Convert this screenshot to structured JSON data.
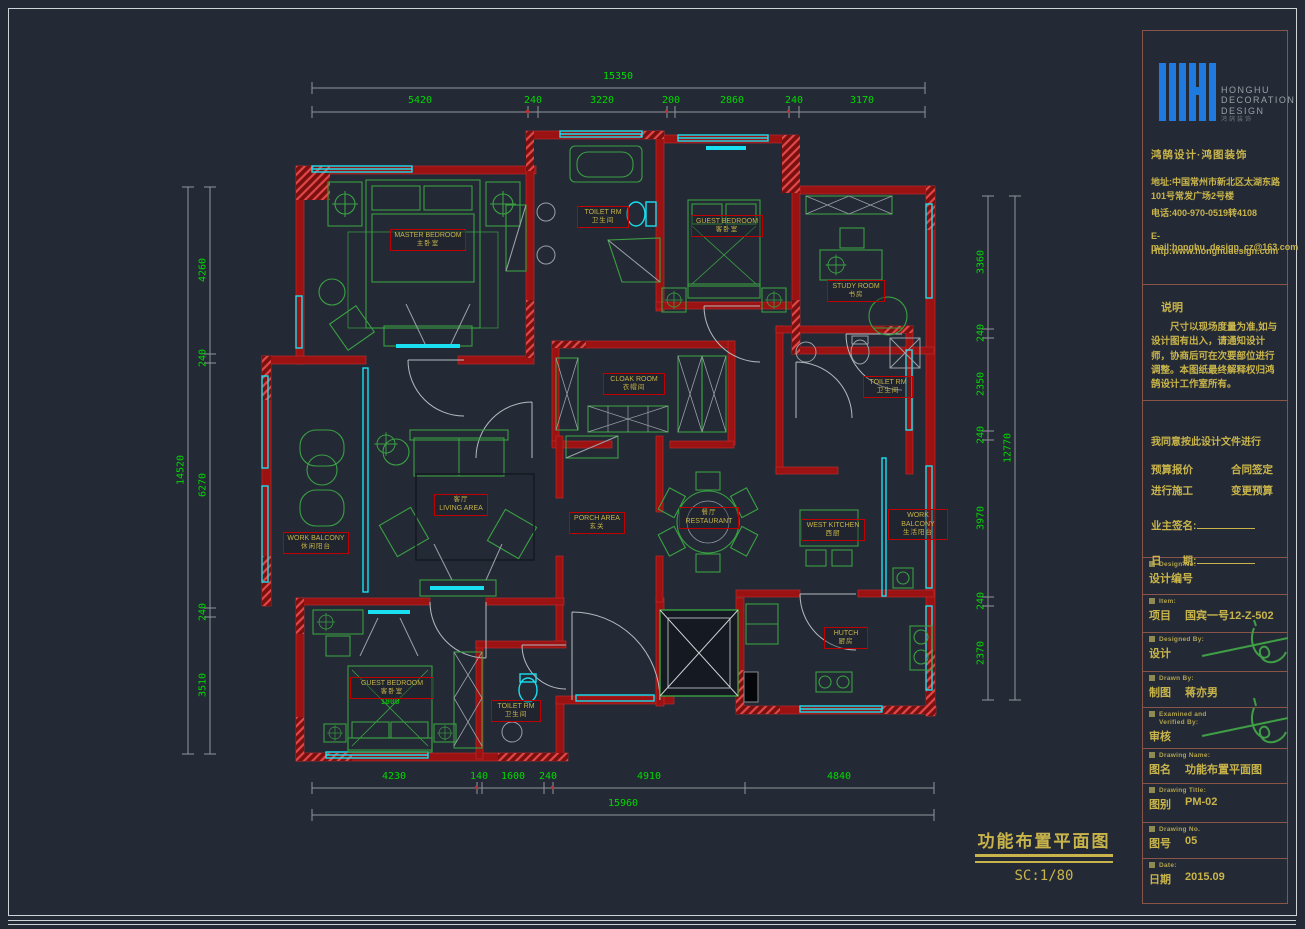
{
  "colors": {
    "background": "#242a35",
    "wall_red": "#9a1212",
    "window_cyan": "#19dff0",
    "furniture_green": "#3aa043",
    "dimension_green": "#00d800",
    "label_yellow": "#c8b44a",
    "label_border_red": "#c00000",
    "titleblock_border_brown": "#8a5548",
    "logo_blue": "#1f7ae0"
  },
  "title_block": {
    "logo": {
      "l1": "HONGHU",
      "l2": "DECORATION",
      "l3": "DESIGN",
      "cn": "鸿鹄装饰"
    },
    "brand_line": "鸿鹄设计·鸿图装饰",
    "address1": "地址:中国常州市新北区太湖东路",
    "address2": "101号常发广场2号楼",
    "phone": "电话:400-970-0519转4108",
    "email": "E-mail:honghu_design_cz@163.com",
    "website": "Http:www.honghudesign.com",
    "notes": {
      "heading": "说明",
      "body1": "尺寸以现场度量为准,如与设计图有出入，请通知设计师，协商后可在次要部位进行调整。",
      "body2": "本图纸最终解释权归鸿鹄设计工作室所有。"
    },
    "agreement": {
      "line": "我同意按此设计文件进行",
      "opt1": "预算报价",
      "opt2": "合同签定",
      "opt3": "进行施工",
      "opt4": "变更预算",
      "owner_sign": "业主签名:",
      "date_label": "日　　期:"
    },
    "rows": {
      "design_no": {
        "en": "Design No:",
        "cn": "设计编号"
      },
      "item": {
        "en": "Item:",
        "cn": "项目",
        "value": "国宾一号12-Z-502"
      },
      "designed_by": {
        "en": "Designed By:",
        "cn": "设计"
      },
      "drawn_by": {
        "en": "Drawn By:",
        "cn": "制图",
        "value": "蒋亦男"
      },
      "examined": {
        "en": "Examined and",
        "en2": "Verified By:",
        "cn": "审核"
      },
      "drawing_name": {
        "en": "Drawing Name:",
        "cn": "图名",
        "value": "功能布置平面图"
      },
      "drawing_title": {
        "en": "Drawing Title:",
        "cn": "图别",
        "value": "PM-02"
      },
      "drawing_no": {
        "en": "Drawing No.",
        "cn": "图号",
        "value": "05"
      },
      "date": {
        "en": "Date:",
        "cn": "日期",
        "value": "2015.09"
      }
    }
  },
  "caption": {
    "title": "功能布置平面图",
    "scale": "SC:1/80"
  },
  "dimensions": {
    "top": {
      "total": "15350",
      "segments": [
        "5420",
        "240",
        "3220",
        "200",
        "2860",
        "240",
        "3170"
      ]
    },
    "bottom": {
      "total": "15960",
      "segments": [
        "4230",
        "140",
        "1600",
        "240",
        "4910",
        "4840"
      ]
    },
    "left": {
      "total": "14520",
      "segments": [
        "4260",
        "240",
        "6270",
        "240",
        "3510"
      ]
    },
    "right": {
      "total": "12770",
      "segments": [
        "3360",
        "240",
        "2350",
        "240",
        "3970",
        "240",
        "2370"
      ]
    },
    "bed_width": "1800"
  },
  "rooms": [
    {
      "en": "MASTER BEDROOM",
      "cn": "主卧室"
    },
    {
      "en": "TOILET RM",
      "cn": "卫生间"
    },
    {
      "en": "GUEST BEDROOM",
      "cn": "客卧室"
    },
    {
      "en": "STUDY ROOM",
      "cn": "书房"
    },
    {
      "en": "CLOAK ROOM",
      "cn": "衣帽间"
    },
    {
      "en": "TOILET RM",
      "cn": "卫生间"
    },
    {
      "en": "LIVING AREA",
      "cn": "客厅"
    },
    {
      "en": "PORCH AREA",
      "cn": "玄关"
    },
    {
      "en": "RESTAURANT",
      "cn": "餐厅"
    },
    {
      "en": "WEST KITCHEN",
      "cn": "西厨"
    },
    {
      "en": "WORK BALCONY",
      "cn": "生活阳台"
    },
    {
      "en": "WORK BALCONY",
      "cn": "休闲阳台"
    },
    {
      "en": "HUTCH",
      "cn": "厨房"
    },
    {
      "en": "GUEST BEDROOM",
      "cn": "客卧室"
    },
    {
      "en": "TOILET RM",
      "cn": "卫生间"
    }
  ]
}
